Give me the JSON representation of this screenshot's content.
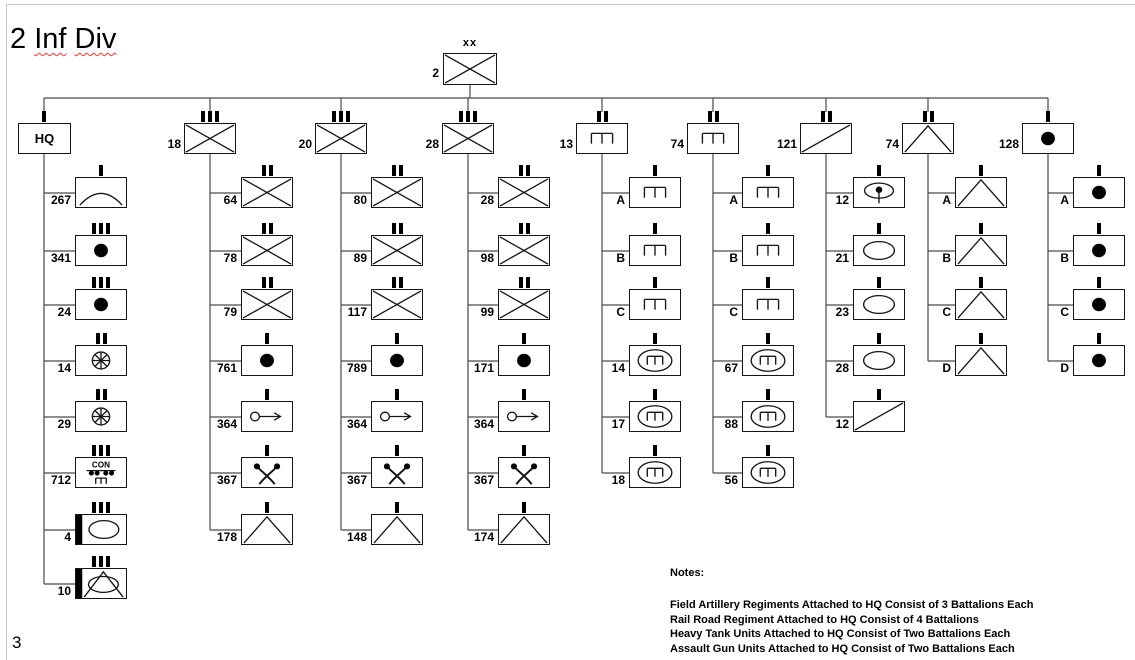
{
  "page": {
    "title_parts": [
      {
        "text": "2 ",
        "misspelled": false
      },
      {
        "text": "Inf",
        "misspelled": true
      },
      {
        "text": " ",
        "misspelled": false
      },
      {
        "text": "Div",
        "misspelled": true
      }
    ],
    "page_number": "3"
  },
  "division": {
    "designation": "2",
    "symbol": "infantry",
    "echelon": "xx"
  },
  "symbols": {
    "railroad_construction_label": "CON"
  },
  "columns": [
    {
      "head": {
        "designation": "HQ",
        "symbol": "hq",
        "echelon": "I"
      },
      "children": [
        {
          "designation": "267",
          "symbol": "signal",
          "echelon": "I"
        },
        {
          "designation": "341",
          "symbol": "artillery",
          "echelon": "III"
        },
        {
          "designation": "24",
          "symbol": "artillery",
          "echelon": "III"
        },
        {
          "designation": "14",
          "symbol": "transport",
          "echelon": "II"
        },
        {
          "designation": "29",
          "symbol": "transport",
          "echelon": "II"
        },
        {
          "designation": "712",
          "symbol": "railroad-construction",
          "echelon": "III"
        },
        {
          "designation": "4",
          "symbol": "heavy-tank",
          "echelon": "III"
        },
        {
          "designation": "10",
          "symbol": "assault-gun",
          "echelon": "III"
        }
      ]
    },
    {
      "head": {
        "designation": "18",
        "symbol": "infantry",
        "echelon": "III"
      },
      "children": [
        {
          "designation": "64",
          "symbol": "infantry",
          "echelon": "II"
        },
        {
          "designation": "78",
          "symbol": "infantry",
          "echelon": "II"
        },
        {
          "designation": "79",
          "symbol": "infantry",
          "echelon": "II"
        },
        {
          "designation": "761",
          "symbol": "artillery",
          "echelon": "I"
        },
        {
          "designation": "364",
          "symbol": "recon",
          "echelon": "I"
        },
        {
          "designation": "367",
          "symbol": "anti-tank",
          "echelon": "I"
        },
        {
          "designation": "178",
          "symbol": "armor",
          "echelon": "I"
        }
      ]
    },
    {
      "head": {
        "designation": "20",
        "symbol": "infantry",
        "echelon": "III"
      },
      "children": [
        {
          "designation": "80",
          "symbol": "infantry",
          "echelon": "II"
        },
        {
          "designation": "89",
          "symbol": "infantry",
          "echelon": "II"
        },
        {
          "designation": "117",
          "symbol": "infantry",
          "echelon": "II"
        },
        {
          "designation": "789",
          "symbol": "artillery",
          "echelon": "I"
        },
        {
          "designation": "364",
          "symbol": "recon",
          "echelon": "I"
        },
        {
          "designation": "367",
          "symbol": "anti-tank",
          "echelon": "I"
        },
        {
          "designation": "148",
          "symbol": "armor",
          "echelon": "I"
        }
      ]
    },
    {
      "head": {
        "designation": "28",
        "symbol": "infantry",
        "echelon": "III"
      },
      "children": [
        {
          "designation": "28",
          "symbol": "infantry",
          "echelon": "II"
        },
        {
          "designation": "98",
          "symbol": "infantry",
          "echelon": "II"
        },
        {
          "designation": "99",
          "symbol": "infantry",
          "echelon": "II"
        },
        {
          "designation": "171",
          "symbol": "artillery",
          "echelon": "I"
        },
        {
          "designation": "364",
          "symbol": "recon",
          "echelon": "I"
        },
        {
          "designation": "367",
          "symbol": "anti-tank",
          "echelon": "I"
        },
        {
          "designation": "174",
          "symbol": "armor",
          "echelon": "I"
        }
      ]
    },
    {
      "head": {
        "designation": "13",
        "symbol": "engineer",
        "echelon": "II"
      },
      "children": [
        {
          "designation": "A",
          "symbol": "engineer",
          "echelon": "I"
        },
        {
          "designation": "B",
          "symbol": "engineer",
          "echelon": "I"
        },
        {
          "designation": "C",
          "symbol": "engineer",
          "echelon": "I"
        },
        {
          "designation": "14",
          "symbol": "armored-engineer",
          "echelon": "I"
        },
        {
          "designation": "17",
          "symbol": "armored-engineer",
          "echelon": "I"
        },
        {
          "designation": "18",
          "symbol": "armored-engineer",
          "echelon": "I"
        }
      ]
    },
    {
      "head": {
        "designation": "74",
        "symbol": "engineer",
        "echelon": "II"
      },
      "children": [
        {
          "designation": "A",
          "symbol": "engineer",
          "echelon": "I"
        },
        {
          "designation": "B",
          "symbol": "engineer",
          "echelon": "I"
        },
        {
          "designation": "C",
          "symbol": "engineer",
          "echelon": "I"
        },
        {
          "designation": "67",
          "symbol": "armored-engineer",
          "echelon": "I"
        },
        {
          "designation": "88",
          "symbol": "armored-engineer",
          "echelon": "I"
        },
        {
          "designation": "56",
          "symbol": "armored-engineer",
          "echelon": "I"
        }
      ]
    },
    {
      "head": {
        "designation": "121",
        "symbol": "cavalry",
        "echelon": "II"
      },
      "children": [
        {
          "designation": "12",
          "symbol": "sp-gun",
          "echelon": "I"
        },
        {
          "designation": "21",
          "symbol": "tank",
          "echelon": "I"
        },
        {
          "designation": "23",
          "symbol": "tank",
          "echelon": "I"
        },
        {
          "designation": "28",
          "symbol": "tank",
          "echelon": "I"
        },
        {
          "designation": "12",
          "symbol": "cavalry",
          "echelon": "I"
        }
      ]
    },
    {
      "head": {
        "designation": "74",
        "symbol": "armor",
        "echelon": "II"
      },
      "children": [
        {
          "designation": "A",
          "symbol": "armor",
          "echelon": "I"
        },
        {
          "designation": "B",
          "symbol": "armor",
          "echelon": "I"
        },
        {
          "designation": "C",
          "symbol": "armor",
          "echelon": "I"
        },
        {
          "designation": "D",
          "symbol": "armor",
          "echelon": "I"
        }
      ]
    },
    {
      "head": {
        "designation": "128",
        "symbol": "artillery",
        "echelon": "I"
      },
      "children": [
        {
          "designation": "A",
          "symbol": "artillery",
          "echelon": "I"
        },
        {
          "designation": "B",
          "symbol": "artillery",
          "echelon": "I"
        },
        {
          "designation": "C",
          "symbol": "artillery",
          "echelon": "I"
        },
        {
          "designation": "D",
          "symbol": "artillery",
          "echelon": "I"
        }
      ]
    }
  ],
  "notes": {
    "heading": "Notes:",
    "lines": [
      "Field Artillery Regiments Attached to HQ Consist of 3 Battalions Each",
      "Rail Road Regiment Attached to HQ Consist of 4 Battalions",
      "Heavy Tank Units Attached to HQ Consist of Two Battalions Each",
      "Assault Gun Units Attached to HQ Consist of Two Battalions Each"
    ]
  }
}
